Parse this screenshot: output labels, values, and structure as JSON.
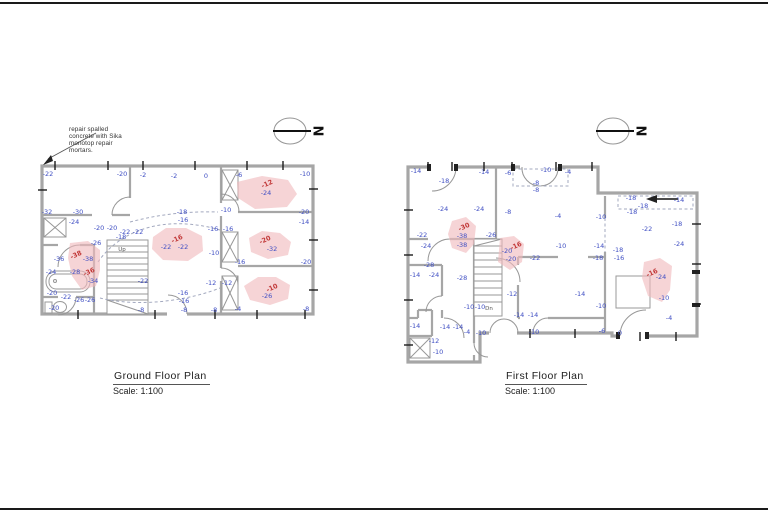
{
  "sheet": {
    "border_color": "#1a1a1a",
    "background": "#ffffff"
  },
  "colors": {
    "measurement_blue": "#3f4ec3",
    "damage_red": "#c23a3a",
    "damage_zone_pink": "#f0b9bd",
    "wall_gray": "#a6a6a6"
  },
  "annotation": {
    "lines": [
      "repair spalled",
      "concrete with Sika",
      "monotop repair",
      "mortars."
    ]
  },
  "north": {
    "label": "N"
  },
  "plans": {
    "ground": {
      "title": "Ground Floor Plan",
      "scale": "Scale: 1:100",
      "stair_label": "Up",
      "labels": [
        {
          "t": "-22",
          "x": 48,
          "y": 174
        },
        {
          "t": "-20",
          "x": 122,
          "y": 174
        },
        {
          "t": "-2",
          "x": 143,
          "y": 175
        },
        {
          "t": "-2",
          "x": 174,
          "y": 176
        },
        {
          "t": "0",
          "x": 206,
          "y": 176
        },
        {
          "t": "-6",
          "x": 239,
          "y": 175
        },
        {
          "t": "-10",
          "x": 305,
          "y": 174
        },
        {
          "t": "-32",
          "x": 47,
          "y": 212
        },
        {
          "t": "-30",
          "x": 78,
          "y": 212
        },
        {
          "t": "-24",
          "x": 74,
          "y": 222
        },
        {
          "t": "-18",
          "x": 182,
          "y": 212
        },
        {
          "t": "-16",
          "x": 183,
          "y": 220
        },
        {
          "t": "-10",
          "x": 226,
          "y": 210
        },
        {
          "t": "-20",
          "x": 304,
          "y": 212
        },
        {
          "t": "-14",
          "x": 304,
          "y": 222
        },
        {
          "t": "-12",
          "x": 267,
          "y": 184,
          "c": "r",
          "rot": -25
        },
        {
          "t": "-24",
          "x": 266,
          "y": 193
        },
        {
          "t": "-20",
          "x": 99,
          "y": 228
        },
        {
          "t": "-20",
          "x": 112,
          "y": 228
        },
        {
          "t": "-22",
          "x": 125,
          "y": 232
        },
        {
          "t": "-22",
          "x": 138,
          "y": 232
        },
        {
          "t": "-18",
          "x": 121,
          "y": 237
        },
        {
          "t": "-26",
          "x": 96,
          "y": 243
        },
        {
          "t": "-16",
          "x": 213,
          "y": 229
        },
        {
          "t": "-16",
          "x": 228,
          "y": 229
        },
        {
          "t": "-16",
          "x": 177,
          "y": 239,
          "c": "r",
          "rot": -25
        },
        {
          "t": "-22",
          "x": 166,
          "y": 247
        },
        {
          "t": "-22",
          "x": 183,
          "y": 247
        },
        {
          "t": "-20",
          "x": 265,
          "y": 240,
          "c": "r",
          "rot": -25
        },
        {
          "t": "-32",
          "x": 272,
          "y": 249
        },
        {
          "t": "-10",
          "x": 214,
          "y": 253
        },
        {
          "t": "-16",
          "x": 240,
          "y": 262
        },
        {
          "t": "-20",
          "x": 306,
          "y": 262
        },
        {
          "t": "-36",
          "x": 59,
          "y": 259
        },
        {
          "t": "-38",
          "x": 76,
          "y": 255,
          "c": "r",
          "rot": -25
        },
        {
          "t": "-38",
          "x": 88,
          "y": 259
        },
        {
          "t": "-24",
          "x": 51,
          "y": 272
        },
        {
          "t": "-28",
          "x": 75,
          "y": 272
        },
        {
          "t": "-36",
          "x": 89,
          "y": 272,
          "c": "r",
          "rot": -25
        },
        {
          "t": "-34",
          "x": 93,
          "y": 281
        },
        {
          "t": "-22",
          "x": 143,
          "y": 281
        },
        {
          "t": "-12",
          "x": 211,
          "y": 283
        },
        {
          "t": "-12",
          "x": 227,
          "y": 283
        },
        {
          "t": "-20",
          "x": 52,
          "y": 293
        },
        {
          "t": "-22",
          "x": 66,
          "y": 297
        },
        {
          "t": "-26",
          "x": 79,
          "y": 300
        },
        {
          "t": "-26",
          "x": 90,
          "y": 300
        },
        {
          "t": "-10",
          "x": 272,
          "y": 288,
          "c": "r",
          "rot": -25
        },
        {
          "t": "-26",
          "x": 267,
          "y": 296
        },
        {
          "t": "-16",
          "x": 183,
          "y": 293
        },
        {
          "t": "-16",
          "x": 184,
          "y": 301
        },
        {
          "t": "-20",
          "x": 54,
          "y": 308
        },
        {
          "t": "-8",
          "x": 141,
          "y": 310
        },
        {
          "t": "-8",
          "x": 184,
          "y": 310
        },
        {
          "t": "-8",
          "x": 214,
          "y": 310
        },
        {
          "t": "-4",
          "x": 238,
          "y": 309
        },
        {
          "t": "-8",
          "x": 306,
          "y": 309
        }
      ]
    },
    "first": {
      "title": "First Floor Plan",
      "scale": "Scale: 1:100",
      "stair_label": "Dn",
      "labels": [
        {
          "t": "-14",
          "x": 416,
          "y": 171
        },
        {
          "t": "-18",
          "x": 444,
          "y": 181
        },
        {
          "t": "-14",
          "x": 484,
          "y": 172
        },
        {
          "t": "-6",
          "x": 508,
          "y": 173
        },
        {
          "t": "-10",
          "x": 546,
          "y": 170
        },
        {
          "t": "-8",
          "x": 536,
          "y": 183
        },
        {
          "t": "-8",
          "x": 536,
          "y": 190
        },
        {
          "t": "-4",
          "x": 568,
          "y": 172
        },
        {
          "t": "-24",
          "x": 443,
          "y": 209
        },
        {
          "t": "-24",
          "x": 479,
          "y": 209
        },
        {
          "t": "-8",
          "x": 508,
          "y": 212
        },
        {
          "t": "-4",
          "x": 558,
          "y": 216
        },
        {
          "t": "-10",
          "x": 601,
          "y": 217
        },
        {
          "t": "-18",
          "x": 631,
          "y": 198
        },
        {
          "t": "-18",
          "x": 643,
          "y": 206
        },
        {
          "t": "-18",
          "x": 632,
          "y": 212
        },
        {
          "t": "-14",
          "x": 679,
          "y": 200
        },
        {
          "t": "-22",
          "x": 647,
          "y": 229
        },
        {
          "t": "-18",
          "x": 677,
          "y": 224
        },
        {
          "t": "-22",
          "x": 422,
          "y": 235
        },
        {
          "t": "-24",
          "x": 426,
          "y": 246
        },
        {
          "t": "-30",
          "x": 464,
          "y": 227,
          "c": "r",
          "rot": -25
        },
        {
          "t": "-38",
          "x": 462,
          "y": 236
        },
        {
          "t": "-38",
          "x": 462,
          "y": 245
        },
        {
          "t": "-26",
          "x": 491,
          "y": 235
        },
        {
          "t": "-16",
          "x": 516,
          "y": 246,
          "c": "r",
          "rot": -25
        },
        {
          "t": "-20",
          "x": 507,
          "y": 251
        },
        {
          "t": "-20",
          "x": 511,
          "y": 259
        },
        {
          "t": "-10",
          "x": 561,
          "y": 246
        },
        {
          "t": "-14",
          "x": 599,
          "y": 246
        },
        {
          "t": "-18",
          "x": 618,
          "y": 250
        },
        {
          "t": "-18",
          "x": 598,
          "y": 258
        },
        {
          "t": "-16",
          "x": 619,
          "y": 258
        },
        {
          "t": "-24",
          "x": 679,
          "y": 244
        },
        {
          "t": "-22",
          "x": 535,
          "y": 258
        },
        {
          "t": "-28",
          "x": 429,
          "y": 265
        },
        {
          "t": "-14",
          "x": 415,
          "y": 275
        },
        {
          "t": "-24",
          "x": 434,
          "y": 275
        },
        {
          "t": "-28",
          "x": 462,
          "y": 278
        },
        {
          "t": "-12",
          "x": 512,
          "y": 294
        },
        {
          "t": "-14",
          "x": 580,
          "y": 294
        },
        {
          "t": "-16",
          "x": 652,
          "y": 273,
          "c": "r",
          "rot": -25
        },
        {
          "t": "-24",
          "x": 661,
          "y": 277
        },
        {
          "t": "-10",
          "x": 664,
          "y": 298
        },
        {
          "t": "-10",
          "x": 601,
          "y": 306
        },
        {
          "t": "-10",
          "x": 469,
          "y": 307
        },
        {
          "t": "-10",
          "x": 480,
          "y": 307
        },
        {
          "t": "-14",
          "x": 519,
          "y": 315
        },
        {
          "t": "-14",
          "x": 533,
          "y": 315
        },
        {
          "t": "-14",
          "x": 415,
          "y": 326
        },
        {
          "t": "-14",
          "x": 445,
          "y": 327
        },
        {
          "t": "-14",
          "x": 458,
          "y": 327
        },
        {
          "t": "-4",
          "x": 467,
          "y": 332
        },
        {
          "t": "-10",
          "x": 481,
          "y": 333
        },
        {
          "t": "-12",
          "x": 434,
          "y": 341
        },
        {
          "t": "-10",
          "x": 438,
          "y": 352
        },
        {
          "t": "-10",
          "x": 534,
          "y": 332
        },
        {
          "t": "-6",
          "x": 602,
          "y": 331
        },
        {
          "t": "0",
          "x": 620,
          "y": 333
        },
        {
          "t": "-4",
          "x": 669,
          "y": 318
        }
      ]
    }
  }
}
